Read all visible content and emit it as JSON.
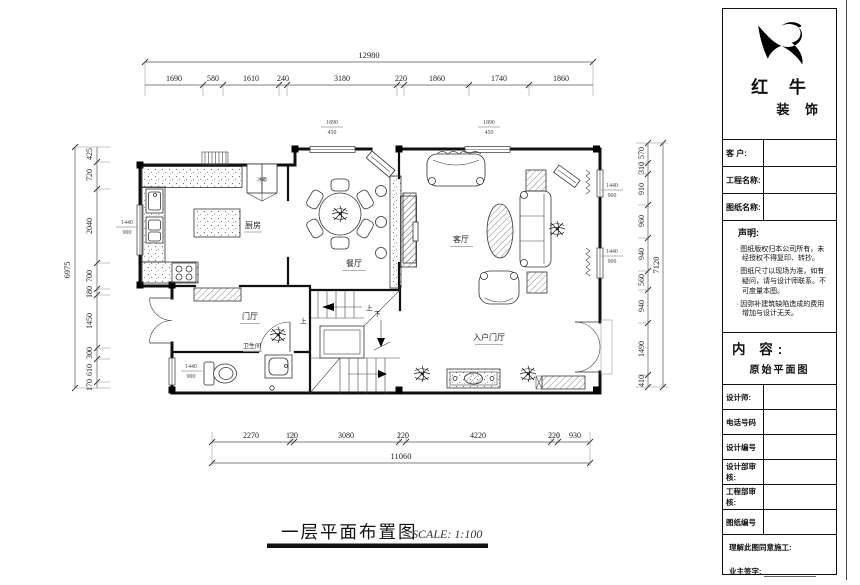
{
  "plan": {
    "caption": {
      "title": "一层平面布置图",
      "scale": "SCALE: 1:100"
    },
    "rooms": {
      "kitchen": "厨房",
      "dining": "餐厅",
      "living": "客厅",
      "foyer": "门厅",
      "bath": "卫生间",
      "entry": "入户门厅",
      "fridge": "冰箱"
    },
    "stairs": {
      "up": "上",
      "down": "下"
    },
    "window_labels": [
      {
        "w": "1440",
        "h": "900"
      },
      {
        "w": "1440",
        "h": "900"
      },
      {
        "w": "1440",
        "h": "900"
      },
      {
        "w": "1440",
        "h": "900"
      },
      {
        "w": "1890",
        "h": "450"
      },
      {
        "w": "1890",
        "h": "450"
      }
    ],
    "dims": {
      "top_total": "12980",
      "top": [
        "1690",
        "580",
        "1610",
        "240",
        "3180",
        "220",
        "1860",
        "1740",
        "1860"
      ],
      "left_total": "6975",
      "left": [
        "425",
        "720",
        "2040",
        "700",
        "180",
        "1450",
        "300",
        "610",
        "170"
      ],
      "right_total": "7120",
      "right": [
        "570",
        "310",
        "910",
        "960",
        "940",
        "560",
        "940",
        "1490",
        "410"
      ],
      "bottom_total": "11060",
      "bottom": [
        "2270",
        "120",
        "3080",
        "220",
        "4220",
        "220",
        "930"
      ]
    }
  },
  "title_block": {
    "brand": {
      "name_top": "红 牛",
      "name_bottom": "装 饰"
    },
    "fields": {
      "customer_label": "客 户:",
      "project_label": "工程名称:",
      "drawing_label": "图纸名称:"
    },
    "statement": {
      "heading": "声明:",
      "items": [
        "图纸版权归本公司所有，未经授权不得复印、转抄。",
        "图纸尺寸以现场为准，如有疑问，请与设计师联系。不可度量本图。",
        "因弥补建筑缺陷造成的费用增加与设计无关。"
      ]
    },
    "content": {
      "heading": "内 容:",
      "value": "原始平面图"
    },
    "rows": [
      "设计师:",
      "电话号码",
      "设计编号",
      "设计部审核:",
      "工程部审核:",
      "图纸编号"
    ],
    "approval": {
      "consent": "理解此图同意施工:",
      "sign": "业主签字:"
    }
  }
}
